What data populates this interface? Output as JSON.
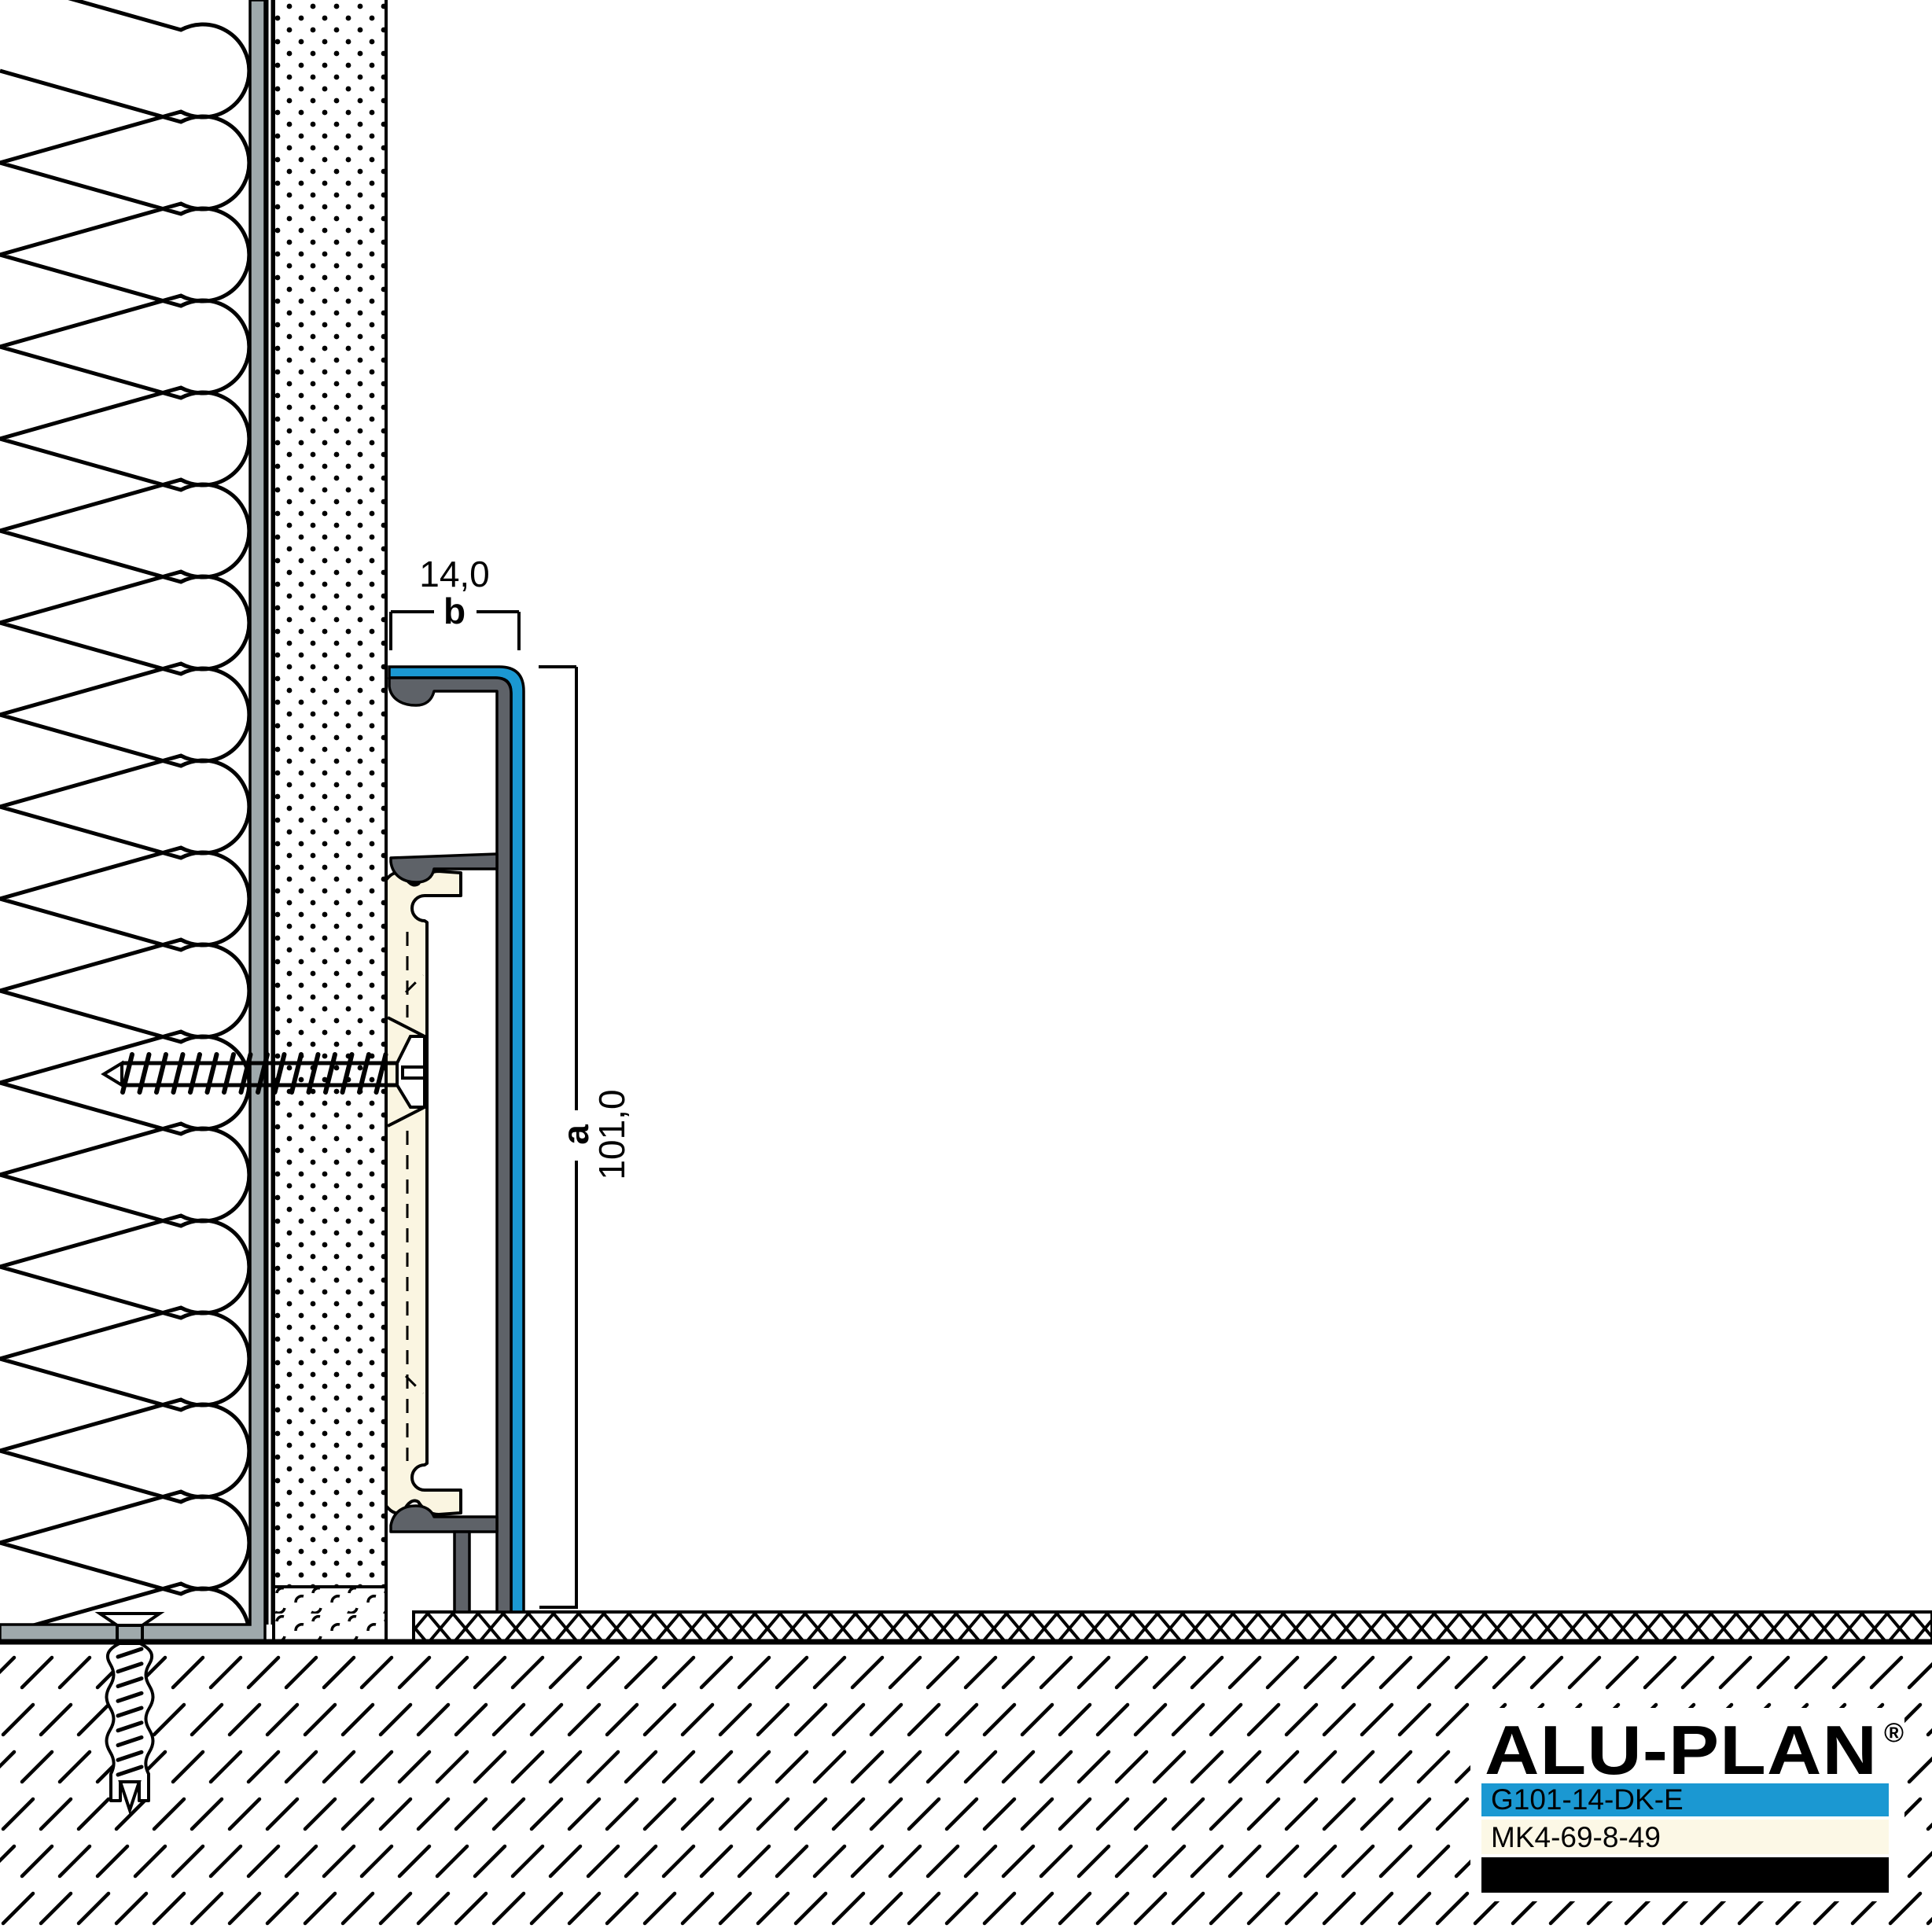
{
  "drawing": {
    "title": "skirting-profile-wall-section",
    "dims": {
      "width": {
        "value": "14,0",
        "label": "b"
      },
      "height": {
        "value": "101,0",
        "label": "a"
      }
    },
    "logo": {
      "text": "ALU-PLAN",
      "registered": "®"
    },
    "product_codes": [
      {
        "code": "G101-14-DK-E"
      },
      {
        "code": "MK4-69-8-49"
      },
      {
        "code": "APT-PVC3"
      }
    ],
    "colors": {
      "accent_cyan": "#1B98D2",
      "profile_gray": "#5E6268",
      "wall_gray": "#9FA9AC",
      "carrier_cream": "#FAF5E1",
      "row_cream": "#FCF8E6",
      "row_black": "#000000",
      "line_black": "#000000"
    }
  }
}
